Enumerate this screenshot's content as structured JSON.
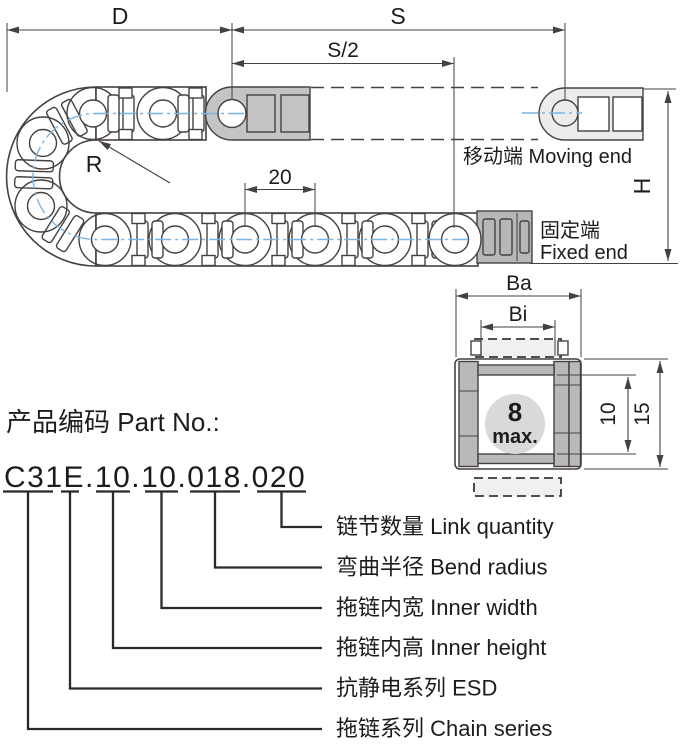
{
  "diagram": {
    "dims": {
      "width_d": "D",
      "travel_s": "S",
      "half_travel": "S/2",
      "pitch": "20",
      "radius": "R",
      "height_h": "H"
    },
    "ends": {
      "moving": "移动端 Moving end",
      "fixed_zh": "固定端",
      "fixed_en": "Fixed end"
    }
  },
  "section": {
    "dims": {
      "outer_width": "Ba",
      "inner_width": "Bi",
      "inner_height": "10",
      "outer_height": "15"
    },
    "insert": {
      "value": "8",
      "unit": "max."
    }
  },
  "part": {
    "heading": "产品编码 Part No.:",
    "number": "C31E.10.10.018.020",
    "breakdown": [
      {
        "code": "020",
        "label": "链节数量 Link quantity"
      },
      {
        "code": "018",
        "label": "弯曲半径 Bend radius"
      },
      {
        "code": "10",
        "label": "拖链内宽 Inner width"
      },
      {
        "code": "10",
        "label": "拖链内高 Inner height"
      },
      {
        "code": "E",
        "label": "抗静电系列 ESD"
      },
      {
        "code": "C31",
        "label": "拖链系列 Chain series"
      }
    ]
  },
  "colors": {
    "line": "#46413e",
    "centerline": "#79b5e3",
    "callout_line": "#2e2824",
    "moving_end_fill": "#ececec",
    "fixed_end_fill": "#b7b7b7",
    "top_bracket_fill": "#c4c4c4",
    "section_bar_fill": "#b9b9b9",
    "separator_fill": "#f0f0f0",
    "max_circle_fill": "#d9d9d9",
    "max_text": "#1456a0"
  }
}
